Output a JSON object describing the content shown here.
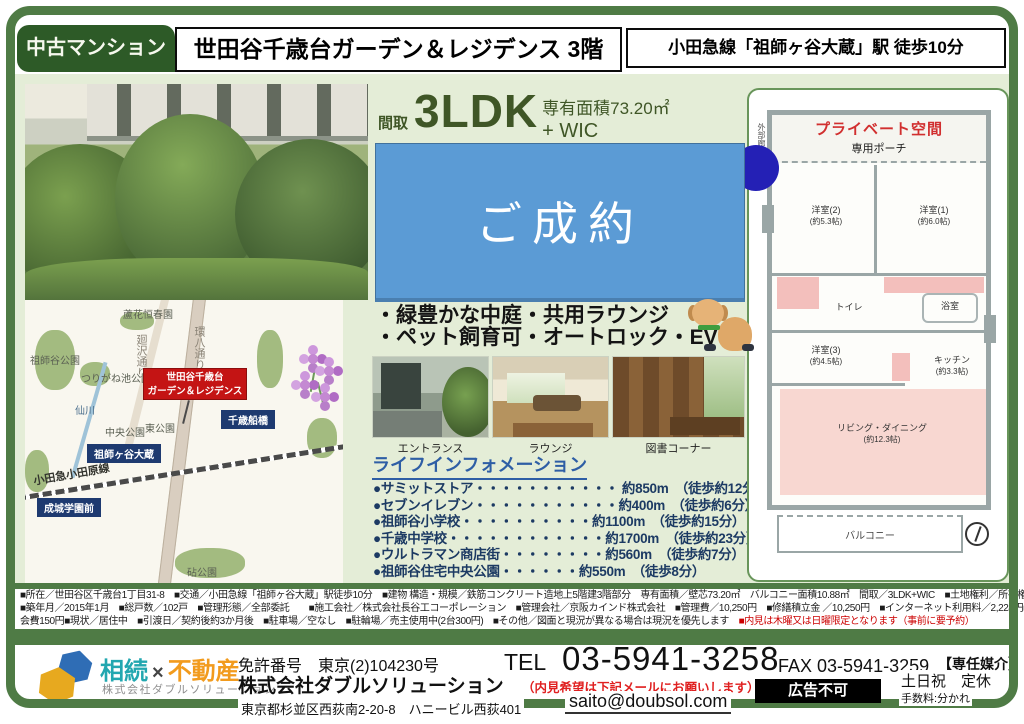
{
  "colors": {
    "frame_green": "#4f7b45",
    "badge_green": "#2d5a27",
    "sold_blue": "#5b9bd5",
    "marker_red": "#c41414",
    "station_navy": "#1e3a70",
    "life_navy": "#1c3a63",
    "bg_light_green": "#e4edd7"
  },
  "header": {
    "badge": "中古マンション",
    "title": "世田谷千歳台ガーデン＆レジデンス 3階",
    "station": "小田急線「祖師ヶ谷大蔵」駅 徒歩10分"
  },
  "spec": {
    "madori_label": "間取",
    "madori": "3LDK",
    "madori_suffix": "+ WIC",
    "area": "専有面積73.20㎡"
  },
  "sold_label": "ご成約",
  "features": [
    "・緑豊かな中庭・共用ラウンジ",
    "・ペット飼育可・オートロック・EV"
  ],
  "photo_captions": [
    "エントランス",
    "ラウンジ",
    "図書コーナー"
  ],
  "life_info": {
    "title": "ライフインフォメーション",
    "items": [
      "●サミットストア・・・・・・・・・・・ 約850m　（徒歩約12分）",
      "●セブンイレブン・・・・・・・・・・・約400m　（徒歩約6分）",
      "●祖師谷小学校・・・・・・・・・・約1100m　（徒歩約15分）",
      "●千歳中学校・・・・・・・・・・・・約1700m　（徒歩約23分）",
      "●ウルトラマン商店街・・・・・・・・約560m　（徒歩約7分）",
      "●祖師谷住宅中央公園・・・・・・約550m　（徒歩8分）"
    ]
  },
  "map": {
    "property_line1": "世田谷千歳台",
    "property_line2": "ガーデン＆レジデンス",
    "stations": [
      "千歳船橋",
      "祖師ヶ谷大蔵",
      "成城学園前"
    ],
    "parks": [
      "蘆花恒春園",
      "祖師谷公園",
      "つりがね池公園",
      "中央公園",
      "東公園",
      "砧公園"
    ],
    "roads": [
      "廻沢通り",
      "環八通り",
      "小田急小田原線"
    ],
    "river": "仙川"
  },
  "floor_plan": {
    "private_space": "プライベート空間",
    "porch": "専用ポーチ",
    "corridor": "外部廊下",
    "rooms": [
      {
        "name": "洋室(2)",
        "size": "(約5.3帖)"
      },
      {
        "name": "洋室(1)",
        "size": "(約6.0帖)"
      },
      {
        "name": "洋室(3)",
        "size": "(約4.5帖)"
      },
      {
        "name": "キッチン",
        "size": "(約3.3帖)"
      },
      {
        "name": "リビング・ダイニング",
        "size": "(約12.3帖)"
      }
    ],
    "toilet": "トイレ",
    "bath": "浴室",
    "balcony": "バルコニー"
  },
  "details": {
    "line1": "■所在／世田谷区千歳台1丁目31-8　■交通／小田急線「祖師ヶ谷大蔵」駅徒歩10分　■建物 構造・規模／鉄筋コンクリート造地上5階建3階部分　専有面積／壁芯73.20㎡　バルコニー面積10.88㎡　間取／3LDK+WIC　■土地権利／所有権",
    "line2": "■築年月／2015年1月　■総戸数／102戸　■管理形態／全部委託　　■施工会社／株式会社長谷工コーポレーション　■管理会社／京阪カインド株式会社　■管理費／10,250円　■修繕積立金 ／10,250円　■インターネット利用料／2,224円■自治",
    "line3": "会費150円■現状／居住中　■引渡日／契約後約3か月後　■駐車場／空なし　■駐輪場／売主使用中(2台300円)　■その他／図面と現況が異なる場合は現況を優先します　",
    "line3_red": "■内見は木曜又は日曜限定となります（事前に要予約）"
  },
  "footer": {
    "logo_word1": "相続",
    "logo_x": "×",
    "logo_word2": "不動産",
    "logo_subtitle": "株式会社ダブルソリューション",
    "license": "免許番号　東京(2)104230号",
    "company": "株式会社ダブルソリューション",
    "address": "東京都杉並区西荻南2-20-8　ハニービル西荻401",
    "tel_label": "TEL",
    "tel": "03-5941-3258",
    "tel_note": "（内見希望は下記メールにお願いします）",
    "email": "saito@doubsol.com",
    "fax": "FAX 03-5941-3259",
    "mediation": "【専任媒介】",
    "no_ad": "広告不可",
    "closed": "土日祝　定休",
    "fee": "手数料:分かれ"
  }
}
